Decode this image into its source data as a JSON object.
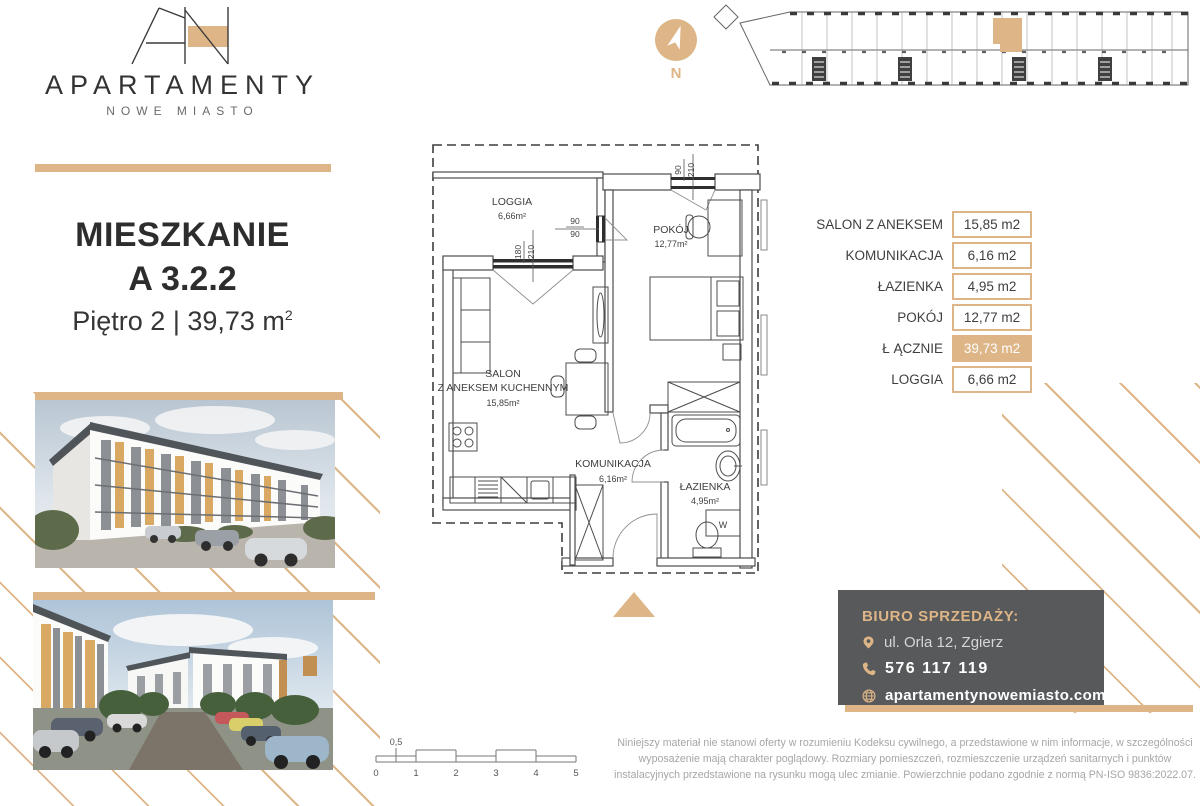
{
  "brand": {
    "monogram": "AN",
    "name": "APARTAMENTY",
    "subname": "NOWE MIASTO"
  },
  "title": {
    "line1": "MIESZKANIE",
    "line2": "A 3.2.2",
    "floor": "Piętro 2",
    "separator": " | ",
    "area": "39,73 m",
    "area_sup": "2"
  },
  "compass": {
    "label": "N"
  },
  "area_table": {
    "rows": [
      {
        "label": "SALON Z ANEKSEM",
        "value": "15,85 m2"
      },
      {
        "label": "KOMUNIKACJA",
        "value": "6,16 m2"
      },
      {
        "label": "ŁAZIENKA",
        "value": "4,95 m2"
      },
      {
        "label": "POKÓJ",
        "value": "12,77 m2"
      },
      {
        "label": "Ł ĄCZNIE",
        "value": "39,73 m2"
      },
      {
        "label": "LOGGIA",
        "value": "6,66 m2"
      }
    ]
  },
  "floor_plan": {
    "rooms": {
      "loggia": {
        "name": "LOGGIA",
        "area": "6,66m²"
      },
      "pokoj": {
        "name": "POKÓJ",
        "area": "12,77m²"
      },
      "salon": {
        "name": "SALON",
        "name2": "Z ANEKSEM KUCHENNYM",
        "area": "15,85m²"
      },
      "komunikacja": {
        "name": "KOMUNIKACJA",
        "area": "6,16m²"
      },
      "lazienka": {
        "name": "ŁAZIENKA",
        "area": "4,95m²"
      }
    },
    "dimensions": {
      "window_pokoj": {
        "w": "90",
        "h": "210"
      },
      "window_loggia": {
        "w": "90",
        "h": "90"
      },
      "door_loggia": {
        "w": "180",
        "h": "210"
      }
    },
    "washer_label": "W"
  },
  "scale_bar": {
    "half_label": "0,5",
    "ticks": [
      "0",
      "1",
      "2",
      "3",
      "4",
      "5"
    ]
  },
  "contact": {
    "heading": "BIURO SPRZEDAŻY:",
    "address": "ul. Orla 12, Zgierz",
    "phone": "576 117 119",
    "website": "apartamentynowemiasto.com"
  },
  "disclaimer": "Niniejszy materiał nie stanowi oferty w rozumieniu Kodeksu cywilnego, a przedstawione w nim informacje, w szczególności wyposażenie mają charakter poglądowy. Rozmiary pomieszczeń, rozmieszczenie urządzeń sanitarnych i punktów instalacyjnych przedstawione na rysunku mogą ulec zmianie. Powierzchnie podano zgodnie z normą PN-ISO 9836:2022.07.",
  "colors": {
    "gold": "#ddb586",
    "dark_box": "#58595b",
    "plan_line": "#4c4c4c",
    "text": "#3f3f3f",
    "muted": "#a6a6a6"
  }
}
